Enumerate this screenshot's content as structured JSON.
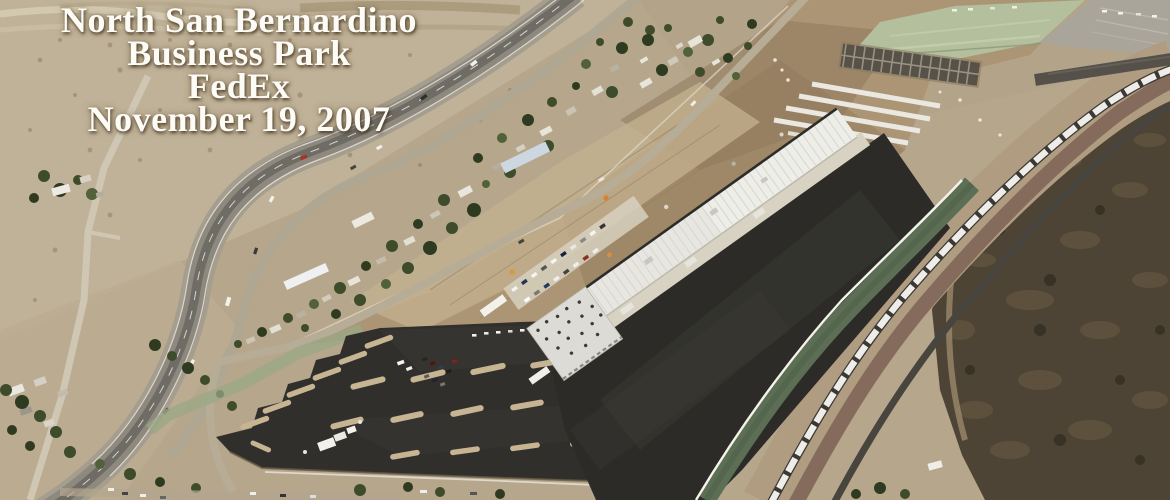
{
  "caption": {
    "lines": [
      "North San Bernardino",
      "Business Park",
      "FedEx",
      "November 19, 2007"
    ]
  },
  "scene": {
    "type": "aerial-photograph",
    "subject": "Aerial view of a FedEx distribution warehouse under construction beside a highway and railroad in desert terrain",
    "palette": {
      "desert_tan": "#b5a68c",
      "light_desert": "#c6b89e",
      "graded_dirt": "#a18a6a",
      "asphalt_dark": "#302f2b",
      "concrete_roof_white": "#e8e7e2",
      "hydroseed_green": "#b3bf9d",
      "slope_green": "#5c6f55",
      "scrub_dark": "#4d4435",
      "rail_corridor_tan": "#b09c81",
      "ballast_red": "#7d6356",
      "highway_gray": "#8e897e",
      "caption_white": "#fcfbf6"
    }
  }
}
